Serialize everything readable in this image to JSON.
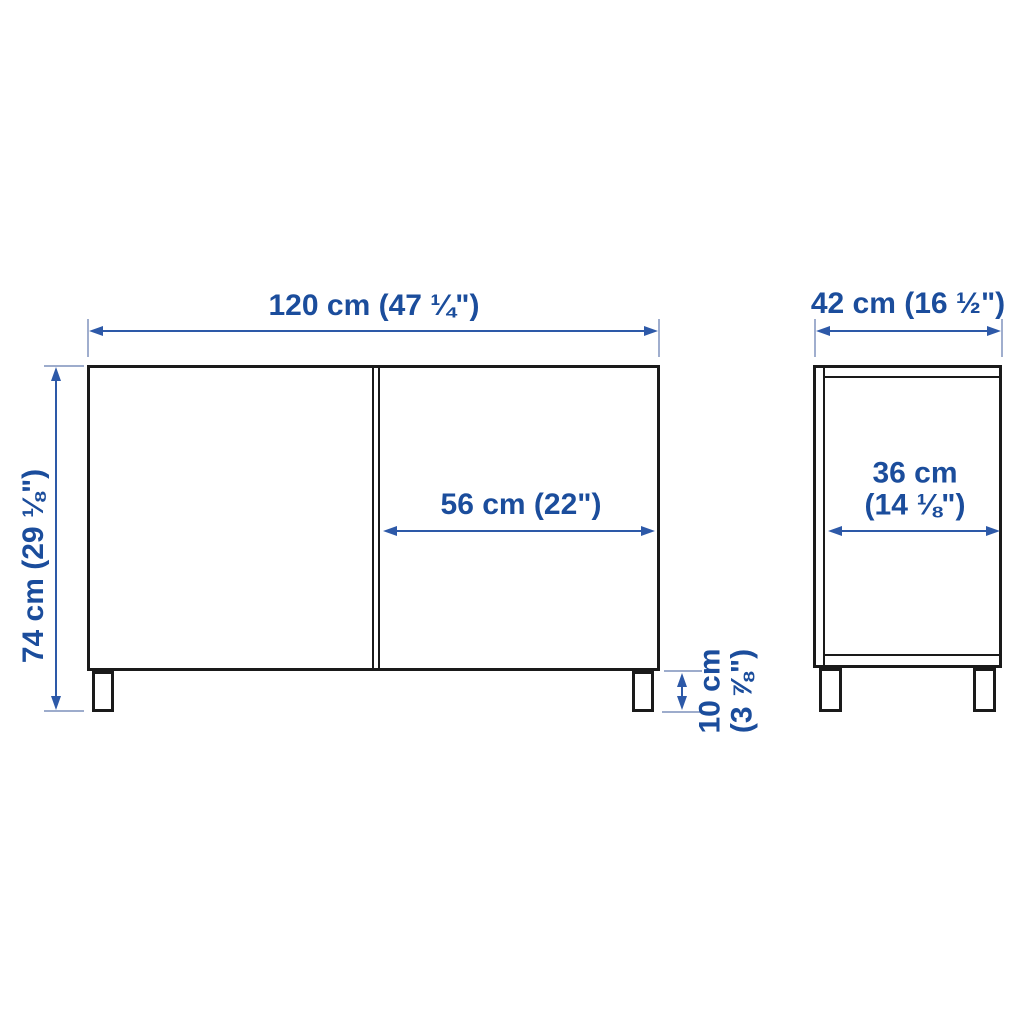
{
  "colors": {
    "background": "#ffffff",
    "outline": "#1a1a1a",
    "dimension_text": "#1b4d9c",
    "dimension_line": "#2d59a8",
    "extension_line": "#8fa0c5"
  },
  "front_view": {
    "width_label": "120 cm (47 ¼\")",
    "height_label": "74 cm (29 ⅛\")",
    "door_width_label": "56 cm (22\")",
    "leg_height_label_line1": "10 cm",
    "leg_height_label_line2": "(3 ⅞\")"
  },
  "side_view": {
    "depth_label": "42 cm (16 ½\")",
    "inner_depth_label_line1": "36 cm",
    "inner_depth_label_line2": "(14 ⅛\")"
  }
}
